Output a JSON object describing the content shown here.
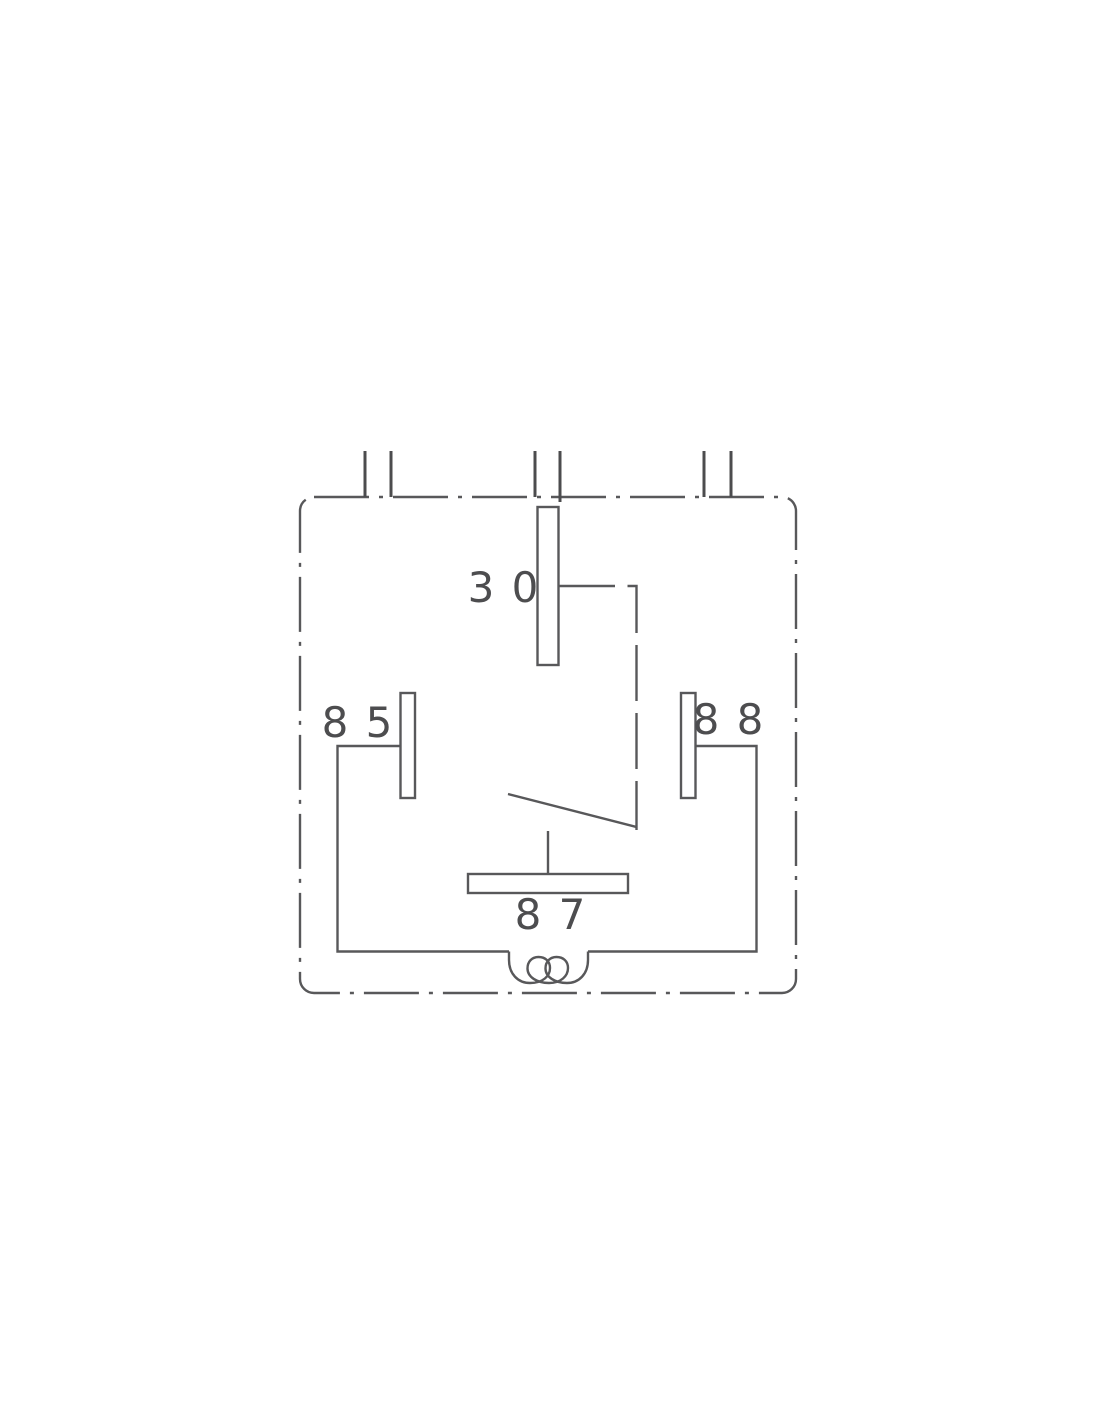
{
  "diagram": {
    "terminals": {
      "t30": {
        "label": "3 0"
      },
      "t85": {
        "label": "8 5"
      },
      "t88": {
        "label": "8 8"
      },
      "t87": {
        "label": "8 7"
      }
    },
    "colors": {
      "line": "#58585a",
      "label": "#4d4d4f",
      "background": "#ffffff"
    }
  }
}
